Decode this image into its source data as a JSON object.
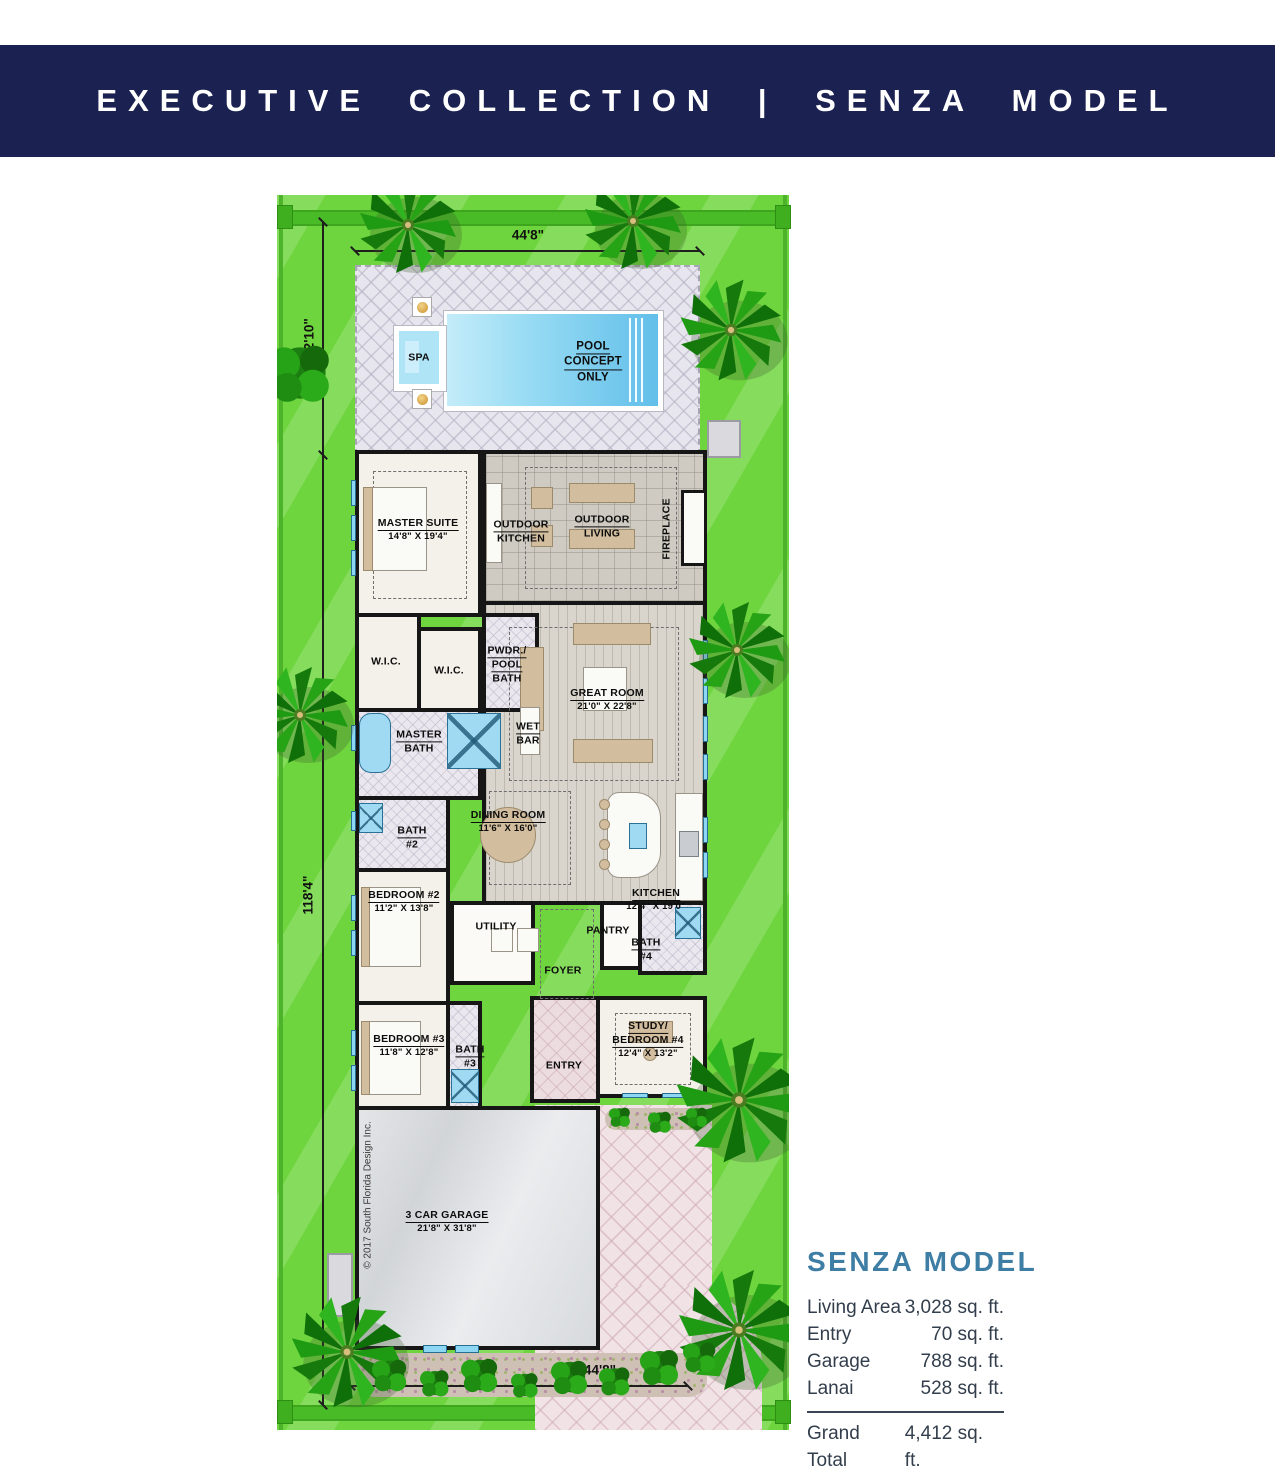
{
  "banner": {
    "title": "EXECUTIVE COLLECTION | SENZA MODEL",
    "bg_color": "#1b2150",
    "text_color": "#ffffff"
  },
  "dimensions": {
    "top": "44'8\"",
    "side_upper": "22'10\"",
    "side_lower": "118'4\"",
    "bottom": "44'8\""
  },
  "pool": {
    "line1": "POOL",
    "line2": "CONCEPT",
    "line3": "ONLY",
    "spa": "SPA"
  },
  "plan": {
    "labels": [
      {
        "lines": [
          "MASTER SUITE"
        ],
        "dims": "14'8\" X 19'4\""
      },
      {
        "lines": [
          "OUTDOOR",
          "KITCHEN"
        ]
      },
      {
        "lines": [
          "OUTDOOR",
          "LIVING"
        ]
      },
      {
        "lines": [
          "FIREPLACE"
        ]
      },
      {
        "lines": [
          "W.I.C."
        ]
      },
      {
        "lines": [
          "W.I.C."
        ]
      },
      {
        "lines": [
          "PWDR./",
          "POOL",
          "BATH"
        ]
      },
      {
        "lines": [
          "MASTER",
          "BATH"
        ]
      },
      {
        "lines": [
          "WET",
          "BAR"
        ]
      },
      {
        "lines": [
          "GREAT ROOM"
        ],
        "dims": "21'0\" X 22'8\""
      },
      {
        "lines": [
          "BATH",
          "#2"
        ]
      },
      {
        "lines": [
          "DINING ROOM"
        ],
        "dims": "11'6\" X 16'0\""
      },
      {
        "lines": [
          "KITCHEN"
        ],
        "dims": "12'4\" X 19'0\""
      },
      {
        "lines": [
          "BEDROOM #2"
        ],
        "dims": "11'2\" X 13'8\""
      },
      {
        "lines": [
          "UTILITY"
        ]
      },
      {
        "lines": [
          "PANTRY"
        ]
      },
      {
        "lines": [
          "BATH",
          "#4"
        ]
      },
      {
        "lines": [
          "FOYER"
        ]
      },
      {
        "lines": [
          "BEDROOM #3"
        ],
        "dims": "11'8\" X 12'8\""
      },
      {
        "lines": [
          "BATH",
          "#3"
        ]
      },
      {
        "lines": [
          "ENTRY"
        ]
      },
      {
        "lines": [
          "STUDY/",
          "BEDROOM #4"
        ],
        "dims": "12'4\" X 13'2\""
      },
      {
        "lines": [
          "3 CAR GARAGE"
        ],
        "dims": "21'8\" X 31'8\""
      }
    ],
    "copyright": "© 2017 South Florida Design Inc."
  },
  "stats": {
    "title": "SENZA MODEL",
    "rows": [
      {
        "label": "Living Area",
        "value": "3,028 sq. ft."
      },
      {
        "label": "Entry",
        "value": "70 sq. ft."
      },
      {
        "label": "Garage",
        "value": "788 sq. ft."
      },
      {
        "label": "Lanai",
        "value": "528 sq. ft."
      }
    ],
    "total": {
      "label": "Grand Total",
      "value": "4,412 sq. ft."
    }
  },
  "colors": {
    "banner_navy": "#1b2150",
    "heading_blue": "#3e7da4",
    "lawn_green": "#6fd53e",
    "property_green": "#49bb26",
    "pool_blue": "#62bfe9",
    "deck_gray": "#e7e5ed",
    "driveway_pink": "#f0e2e5",
    "wall_black": "#161616"
  }
}
